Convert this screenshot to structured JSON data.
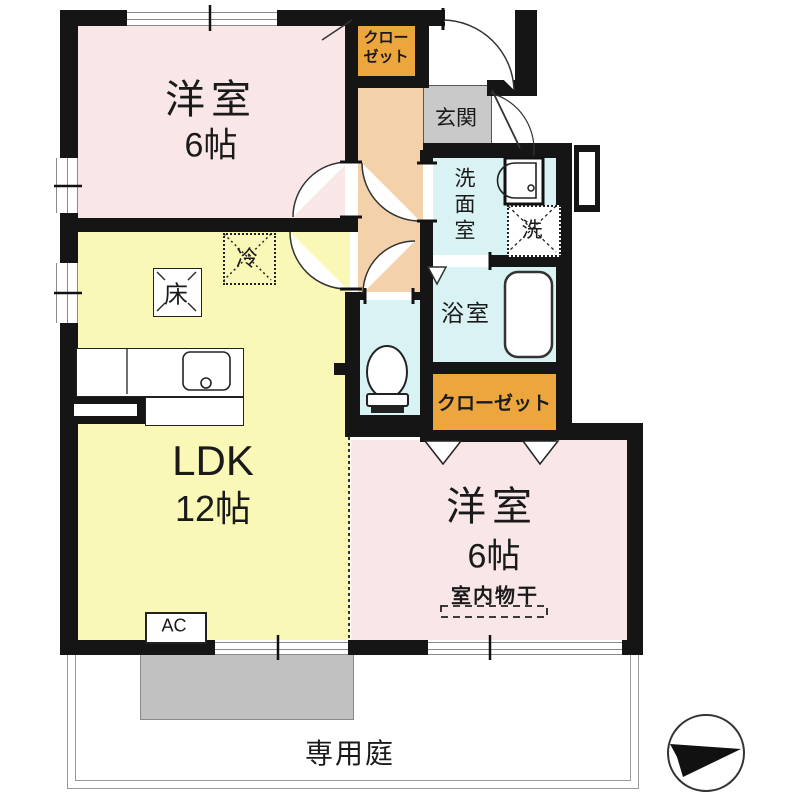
{
  "plan": {
    "bedroom_top": {
      "name": "洋室",
      "size": "6帖"
    },
    "closet_top": {
      "line1": "クロー",
      "line2": "ゼット"
    },
    "entrance": {
      "label": "玄関"
    },
    "washroom": {
      "label": "洗面室"
    },
    "washer": {
      "label": "洗"
    },
    "bath": {
      "label": "浴室"
    },
    "closet_mid": {
      "label": "クローゼット"
    },
    "ldk": {
      "name": "LDK",
      "size": "12帖"
    },
    "refrigerator": {
      "label": "冷"
    },
    "floor_storage": {
      "label": "床"
    },
    "ac": {
      "label": "AC"
    },
    "bedroom_bottom": {
      "name": "洋室",
      "size": "6帖",
      "drying": "室内物干"
    },
    "garden": {
      "label": "専用庭"
    }
  },
  "colors": {
    "room_pink": "#f9e7e7",
    "ldk_yellow": "#f9f8b6",
    "hall_peach": "#f3d2ab",
    "wet_cyan": "#d9f2f4",
    "closet_orange": "#eda63e",
    "genkan_gray": "#c9c9c9",
    "terrace_gray": "#c1c1c1",
    "wall_black": "#151515"
  }
}
